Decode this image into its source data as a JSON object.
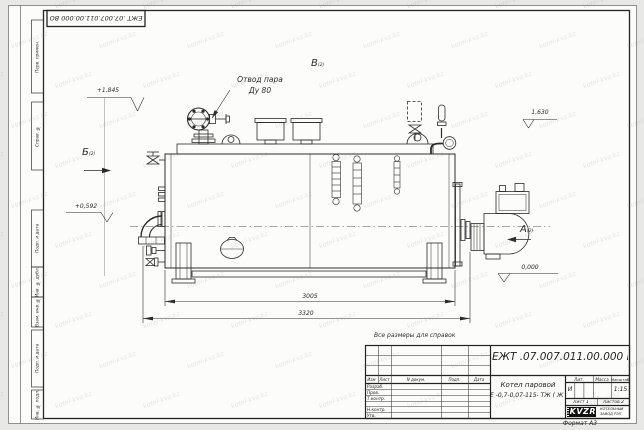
{
  "watermark": "kotel-kvz.kz",
  "corner_stamp": "ЕЖТ .07.007.011.00.000  ВО",
  "margin": {
    "boxes": [
      "Перв. примен.",
      "Справ. №",
      "Подп. и дата",
      "Инв. № дубл.",
      "Взам. инв. №",
      "Подп. и дата",
      "Инв. № подл."
    ]
  },
  "drawing": {
    "note": "Все размеры для справок",
    "steam_outlet": {
      "line1": "Отвод пара",
      "line2": "Ду 80"
    },
    "views": {
      "a": "А",
      "b_left": "Б",
      "v_top": "В",
      "sheet_ref": "(2)"
    },
    "levels": {
      "top": "+1,845",
      "right": "1,630",
      "left": "+0,592",
      "zero": "0,000"
    },
    "dims": {
      "inner": "3005",
      "outer": "3320"
    }
  },
  "title_block": {
    "doc_number": "ЕЖТ .07.007.011.00.000  ВО",
    "product_name": "Котел паровой",
    "product_code": "Е -0,7-0,07-115- ТЖ ( Ж )",
    "cols": {
      "izm": "Изм",
      "list": "Лист",
      "doc": "N докум.",
      "podp": "Подп.",
      "data": "Дата"
    },
    "roles": [
      "Разраб.",
      "Пров.",
      "Т.контр.",
      "",
      "Н.контр.",
      "Утв."
    ],
    "lit": {
      "header": "Лит.",
      "value": "И"
    },
    "mass": {
      "header": "Масса",
      "value": ""
    },
    "scale": {
      "header": "Масштаб",
      "value": "1:15"
    },
    "sheet_label": "Лист 1",
    "sheets_label": "Листов 2",
    "company": {
      "logo": "KVZR",
      "line1": "КОТЕЛЬНЫЙ",
      "line2": "ЗАВОД РЭП"
    },
    "format": "Формат А3"
  }
}
